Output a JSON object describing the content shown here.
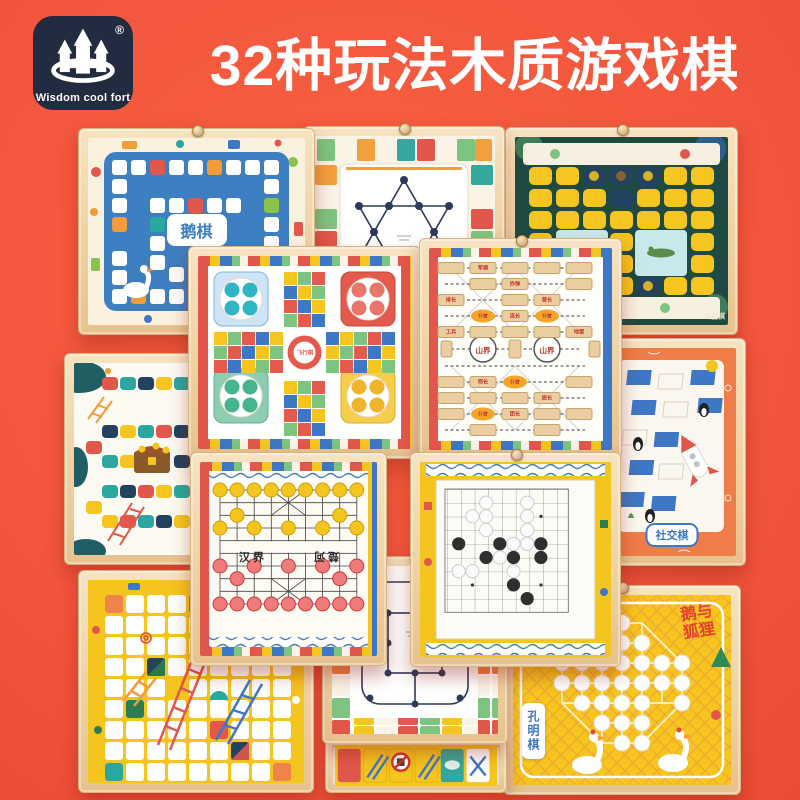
{
  "page": {
    "background": "#F3573E"
  },
  "logo": {
    "brand": "Wisdom cool fort",
    "registered": "®"
  },
  "title": "32种玩法木质游戏棋",
  "boards": {
    "goose": {
      "name": "鹅棋",
      "arrived": "ARRIVED"
    },
    "animal_chess": {
      "name": "斗兽棋"
    },
    "flying_chess": {
      "name": "飞行棋"
    },
    "military_chess": {
      "mountain": "山界",
      "camp": "行营",
      "pieces": [
        "军旗",
        "炸弹",
        "排长",
        "营长",
        "连长",
        "工兵",
        "地雷",
        "师长",
        "旅长",
        "团长"
      ]
    },
    "social_chess": {
      "name": "社交棋"
    },
    "chinese_chess": {
      "river_left": "汉界",
      "river_right": "楚河"
    },
    "fox_goose": {
      "name": "鹅与狐狸"
    },
    "peg_solitaire": {
      "name": "孔明棋"
    }
  }
}
